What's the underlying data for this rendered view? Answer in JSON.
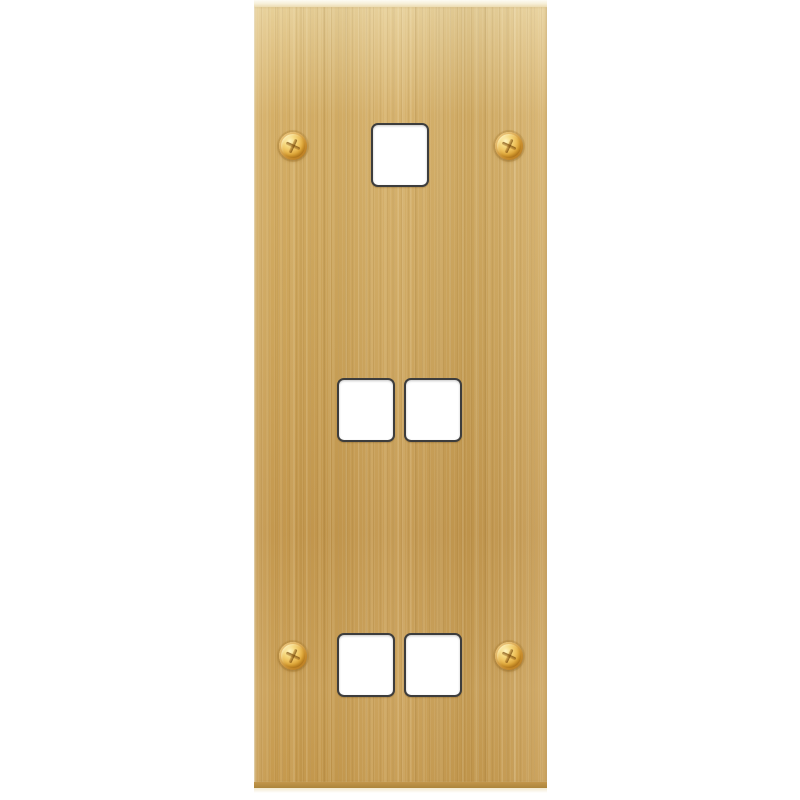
{
  "image": {
    "type": "product-photo",
    "subject": "brushed satin brass multi-gang grid faceplate",
    "visible_text": ""
  },
  "plate": {
    "finish": "brushed-satin-brass",
    "grain_direction": "vertical",
    "cutouts": {
      "count": 5,
      "shape": "rounded-square",
      "rows": [
        {
          "position": "top",
          "count": 1
        },
        {
          "position": "middle",
          "count": 2
        },
        {
          "position": "bottom",
          "count": 2
        }
      ]
    },
    "screws": {
      "count": 4,
      "head": "phillips",
      "positions": [
        "top-left",
        "top-right",
        "bottom-left",
        "bottom-right"
      ]
    }
  },
  "theme": {
    "background": "#ffffff",
    "plate-base": "#cda55b",
    "plate-light": "#e7cf97",
    "plate-mid": "#d5af67",
    "plate-dark": "#c4984e",
    "plate-top-edge": "#f7f0da",
    "plate-bottom-edge": "#ac853b",
    "plate-bottom-glow": "#f3e9cf",
    "cutout-fill": "#ffffff",
    "cutout-border": "#3d3d3d",
    "screw-highlight": "#fff3bd",
    "screw-gold": "#eec05a",
    "screw-bronze": "#c4851f",
    "screw-shadow": "#9d6614",
    "screw-slot": "#6e4105"
  }
}
